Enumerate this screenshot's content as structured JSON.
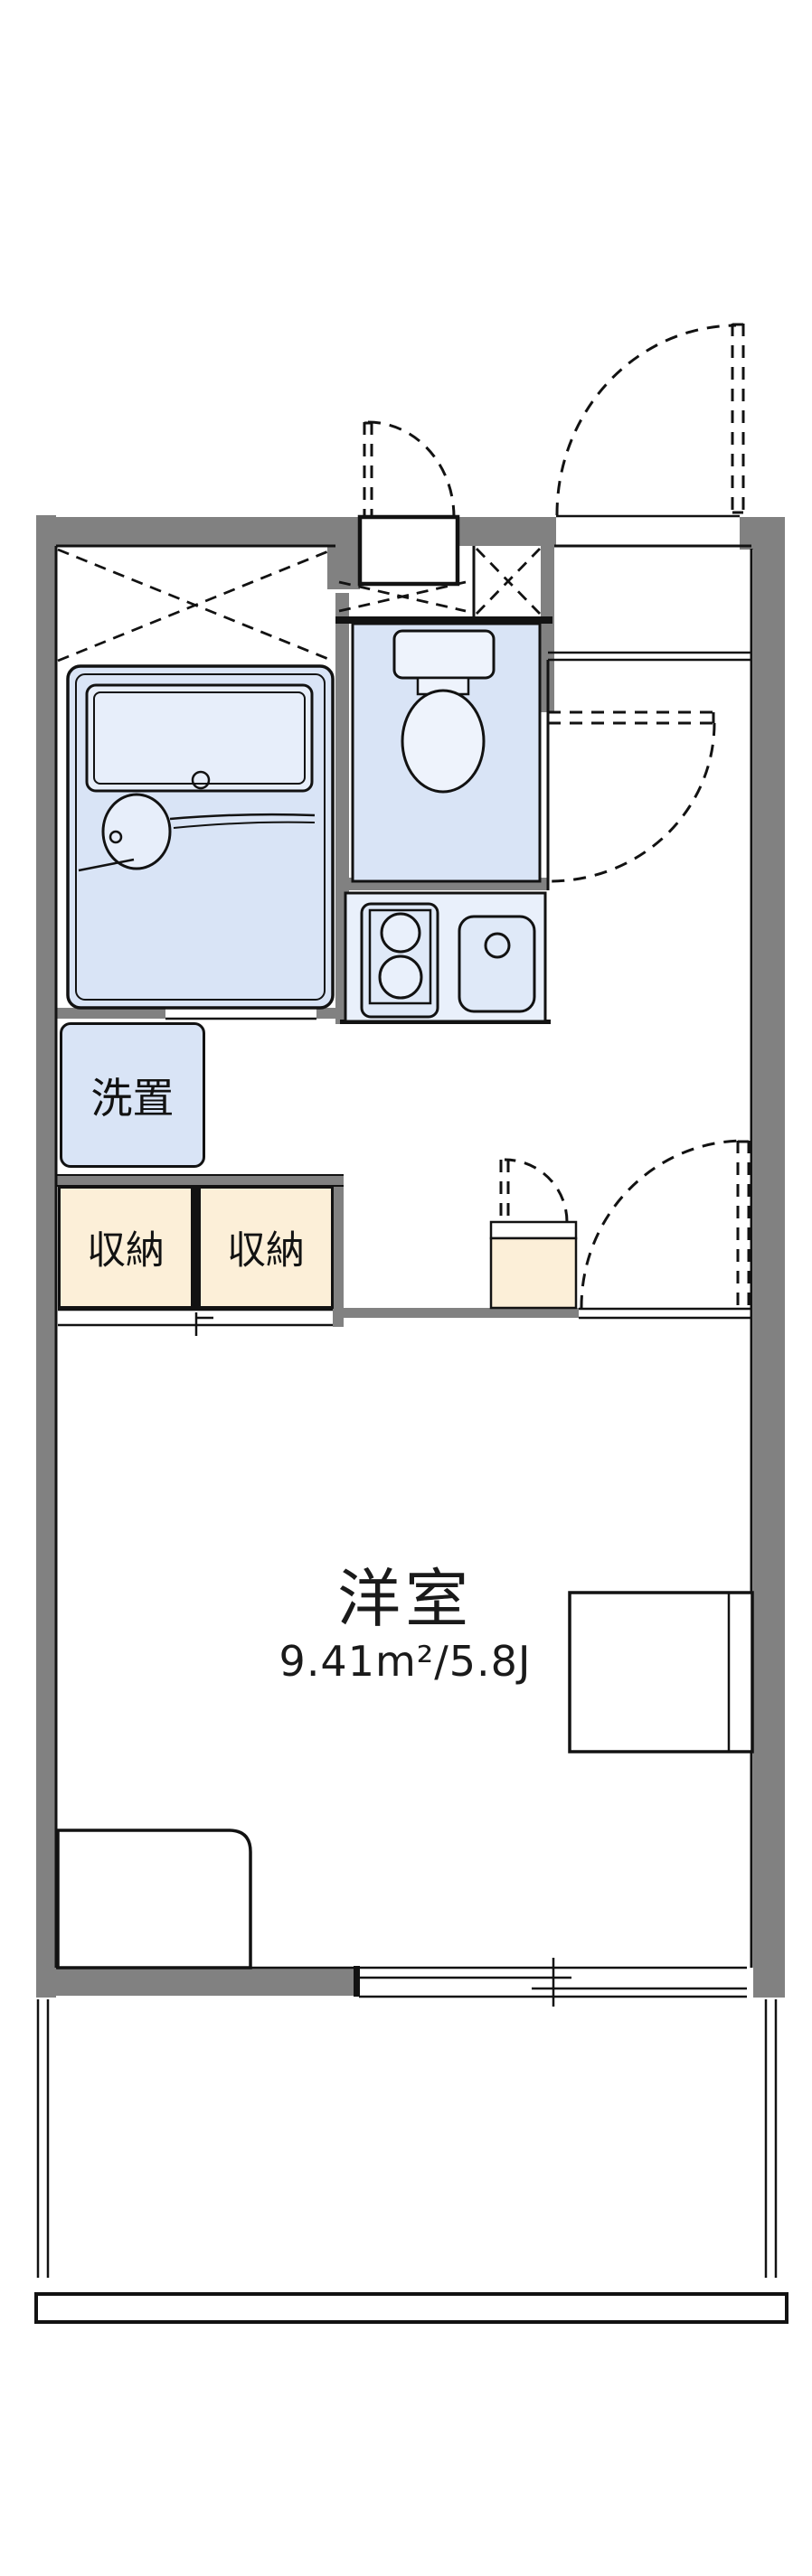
{
  "floorplan": {
    "title": "1K apartment floor plan",
    "labels": {
      "laundry": "洗置",
      "storage_left": "収納",
      "storage_right": "収納",
      "main_room_name": "洋室",
      "main_room_size": "9.41m²/5.8J"
    },
    "rooms": [
      {
        "name": "洋室",
        "area_m2": "9.41",
        "area_tatami": "5.8J"
      },
      {
        "name": "洗置",
        "type": "laundry-space"
      },
      {
        "name": "収納",
        "type": "storage"
      },
      {
        "name": "収納",
        "type": "storage"
      }
    ],
    "colors": {
      "wall": "#818181",
      "line": "#121212",
      "wet_area_floor": "#d9e4f6",
      "fixture_fill": "#e7eefa",
      "storage_fill": "#fcefd8",
      "background": "#ffffff"
    }
  }
}
